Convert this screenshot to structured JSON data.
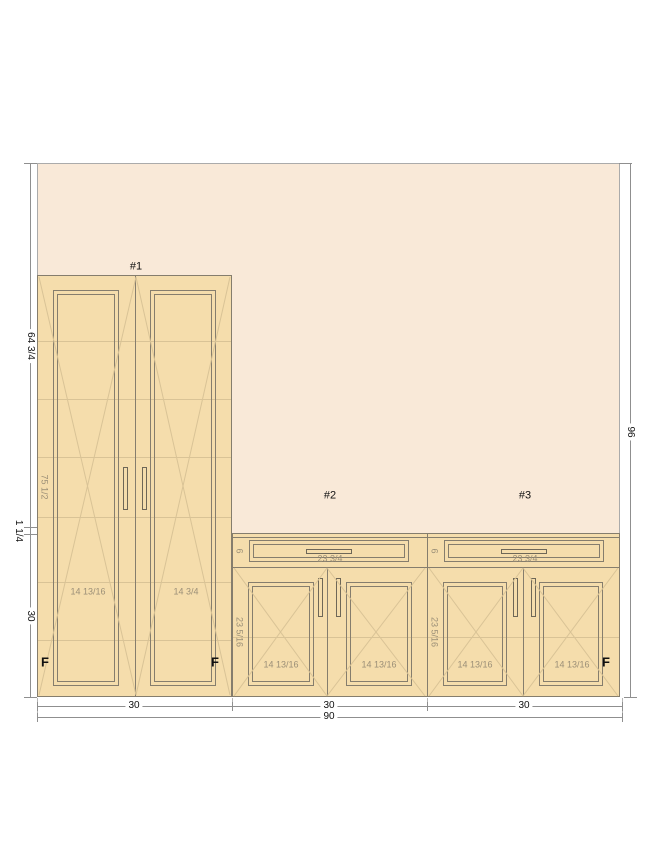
{
  "cabinet1": {
    "label": "#1",
    "left_door_width": "14 13/16",
    "right_door_width": "14 3/4",
    "opening_height": "75 1/2",
    "f_left": "F",
    "f_right": "F"
  },
  "cabinet2": {
    "label": "#2",
    "drawer_front_height": "6",
    "drawer_width": "23 3/4",
    "door_opening_height": "23 5/16",
    "left_door_width": "14 13/16",
    "right_door_width": "14 13/16"
  },
  "cabinet3": {
    "label": "#3",
    "drawer_front_height": "6",
    "drawer_width": "23 3/4",
    "door_opening_height": "23 5/16",
    "left_door_width": "14 13/16",
    "right_door_width": "14 13/16",
    "f_right": "F"
  },
  "dimensions": {
    "upper_left_height": "64 3/4",
    "countertop_thickness": "1 1/4",
    "base_height": "30",
    "total_height": "96",
    "width_cab1": "30",
    "width_cab2": "30",
    "width_cab3": "30",
    "total_width": "90"
  },
  "colors": {
    "wall": "#f9e9d8",
    "cabinet": "#f5ddac",
    "outline": "#857d6d",
    "faint": "#d9c396",
    "dim": "#8f8f8f",
    "ink": "#111111",
    "graytext": "#9b8f77"
  }
}
